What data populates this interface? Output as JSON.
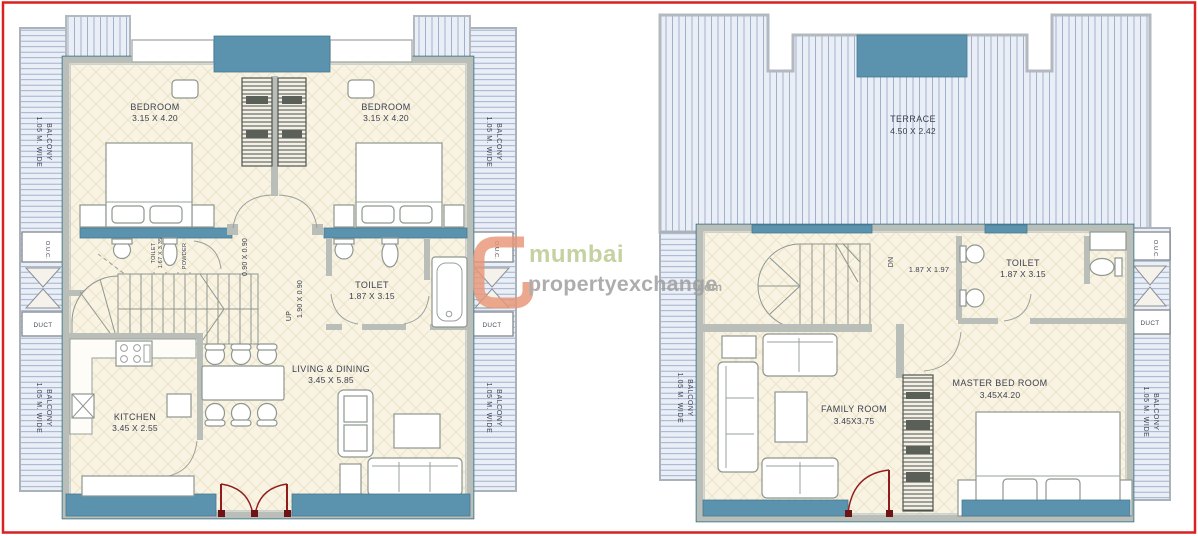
{
  "watermark": {
    "brand": "mumbai",
    "brand2": "propertyexchange",
    "tld": ".com"
  },
  "common": {
    "balcony": "BALCONY",
    "balcony_width": "1.05 M. WIDE",
    "duct": "DUCT",
    "ouc": "O.U.C."
  },
  "floor1": {
    "bedroom_left_name": "BEDROOM",
    "bedroom_left_dims": "3.15 X 4.20",
    "bedroom_right_name": "BEDROOM",
    "bedroom_right_dims": "3.15 X 4.20",
    "wc_small_name": "TOILET",
    "wc_small_dims": "1.67 X 3.35",
    "powder": "POWDER",
    "toilet_name": "TOILET",
    "toilet_dims": "1.87 X 3.15",
    "kitchen_name": "KITCHEN",
    "kitchen_dims": "3.45 X 2.55",
    "living_name": "LIVING & DINING",
    "living_dims": "3.45 X 5.85",
    "lobby_dims": "0.90 X 0.90",
    "passage_dims": "1.90 X 0.90",
    "up": "UP"
  },
  "floor2": {
    "terrace_name": "TERRACE",
    "terrace_dims": "4.50 X 2.42",
    "dn": "DN",
    "stair_dims": "1.87 X 1.97",
    "toilet_name": "TOILET",
    "toilet_dims": "1.87 X 3.15",
    "family_name": "FAMILY ROOM",
    "family_dims": "3.45X3.75",
    "master_name": "MASTER BED ROOM",
    "master_dims": "3.45X4.20"
  }
}
